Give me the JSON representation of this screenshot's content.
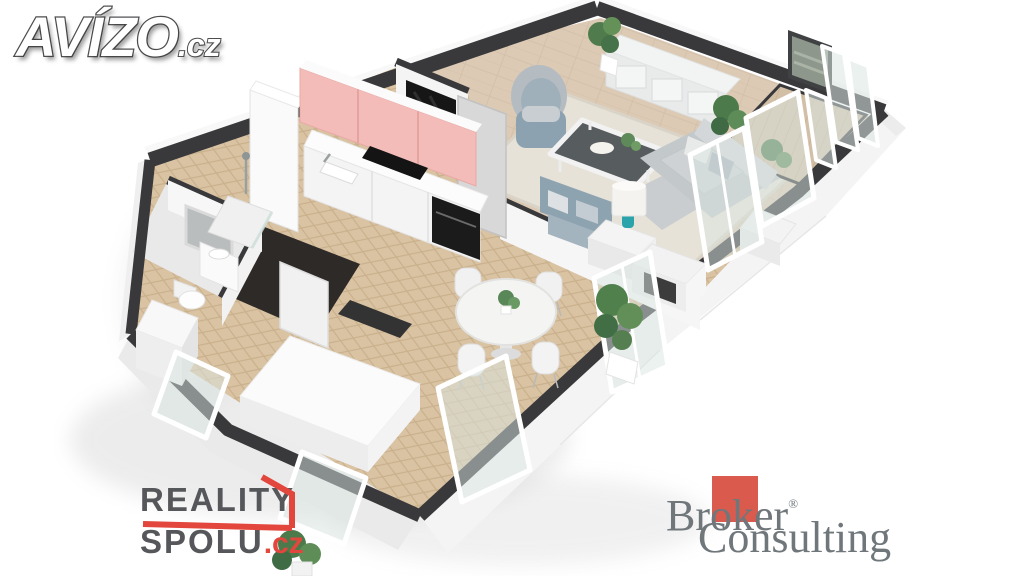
{
  "page": {
    "background_color": "#ffffff",
    "scene": "3D isometric dollhouse floor plan render of a one-room apartment with open kitchen, dining area, living room, bathroom and balcony"
  },
  "watermarks": {
    "avizo": {
      "name": "AVÍZO",
      "tld": ".cz"
    },
    "reality_spolu": {
      "word1": "REALITY",
      "word2": "SPOLU",
      "tld": ".cz",
      "text_color": "#56575a",
      "accent_color": "#e2463c"
    },
    "broker_consulting": {
      "word1": "Broker",
      "word2": "Consulting",
      "registered_mark": "®",
      "text_color": "#70777b",
      "accent_color": "#da5a4e"
    }
  },
  "floorplan": {
    "rooms": [
      {
        "id": "living-room",
        "floor": "beige tile with cream rug"
      },
      {
        "id": "kitchen-dining-area",
        "floor": "herringbone oak parquet"
      },
      {
        "id": "entry-hall",
        "floor": "dark tile"
      },
      {
        "id": "bathroom",
        "floor": "light grey tile"
      },
      {
        "id": "balcony",
        "floor": "beige decking with glass railing"
      }
    ],
    "furniture": [
      "kitchen-upper-cabinets-pink",
      "kitchen-counter",
      "cooktop",
      "kitchen-sink",
      "black-extractor-column",
      "tall-cabinet",
      "kitchen-island",
      "entry-door",
      "coat-niche",
      "bathroom-door",
      "mirror",
      "washbasin",
      "toilet",
      "shower",
      "washing-machine",
      "dining-table",
      "dining-chairs-x4",
      "tv-sideboard",
      "armchair",
      "coffee-table",
      "loveseat",
      "sofa",
      "side-table-with-lamp",
      "side-table-open",
      "table-lamp",
      "wall-art",
      "potted-plants",
      "window-frames",
      "balcony-glazing"
    ],
    "palette": {
      "wall_top": "#39393b",
      "wall_face": "#f3f3f3",
      "herringbone_wood": "#d9c3a3",
      "living_floor": "#dccab5",
      "rug": "#e6e2d7",
      "kitchen_pink": "#f3bcb8",
      "sofa_grey": "#c6cacc",
      "loveseat_blue": "#8ea3b0",
      "lamp_teal": "#2aa4aa",
      "plant_green": "#55824f",
      "glass": "#d9e6e2",
      "entry_floor_dark": "#2e2a28",
      "balcony_floor": "#d2bfa6",
      "appliance_black": "#141414"
    }
  }
}
